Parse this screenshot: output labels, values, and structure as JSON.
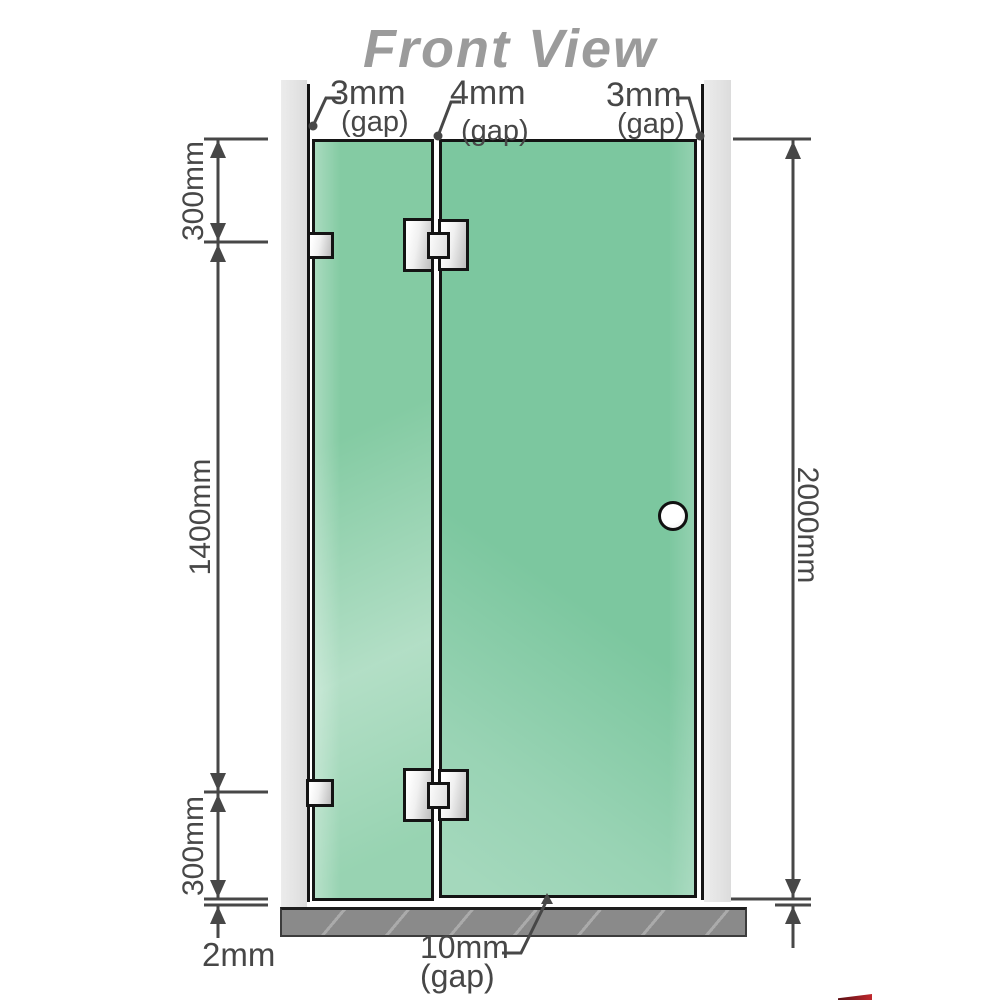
{
  "title": "Front View",
  "colors": {
    "panel-green": "#7cc79f",
    "panel-green-hi": "#bfe9d3",
    "wall-gray": "#e3e3e3",
    "floor-gray": "#8a8a8a",
    "line-black": "#141414",
    "dim": "#474747",
    "title-gray": "#9b9b9b",
    "metal-a": "#ffffff",
    "metal-b": "#c2c2c2"
  },
  "top_gap_labels": [
    {
      "value": "3mm",
      "suffix": "(gap)"
    },
    {
      "value": "4mm",
      "suffix": "(gap)"
    },
    {
      "value": "3mm",
      "suffix": "(gap)"
    }
  ],
  "left_dimensions": {
    "top": "300mm",
    "middle": "1400mm",
    "bottom": "300mm"
  },
  "right_dimension": "2000mm",
  "bottom_dimensions": {
    "floor_gap": "2mm",
    "door_gap": "10mm",
    "door_gap_suffix": "(gap)"
  }
}
